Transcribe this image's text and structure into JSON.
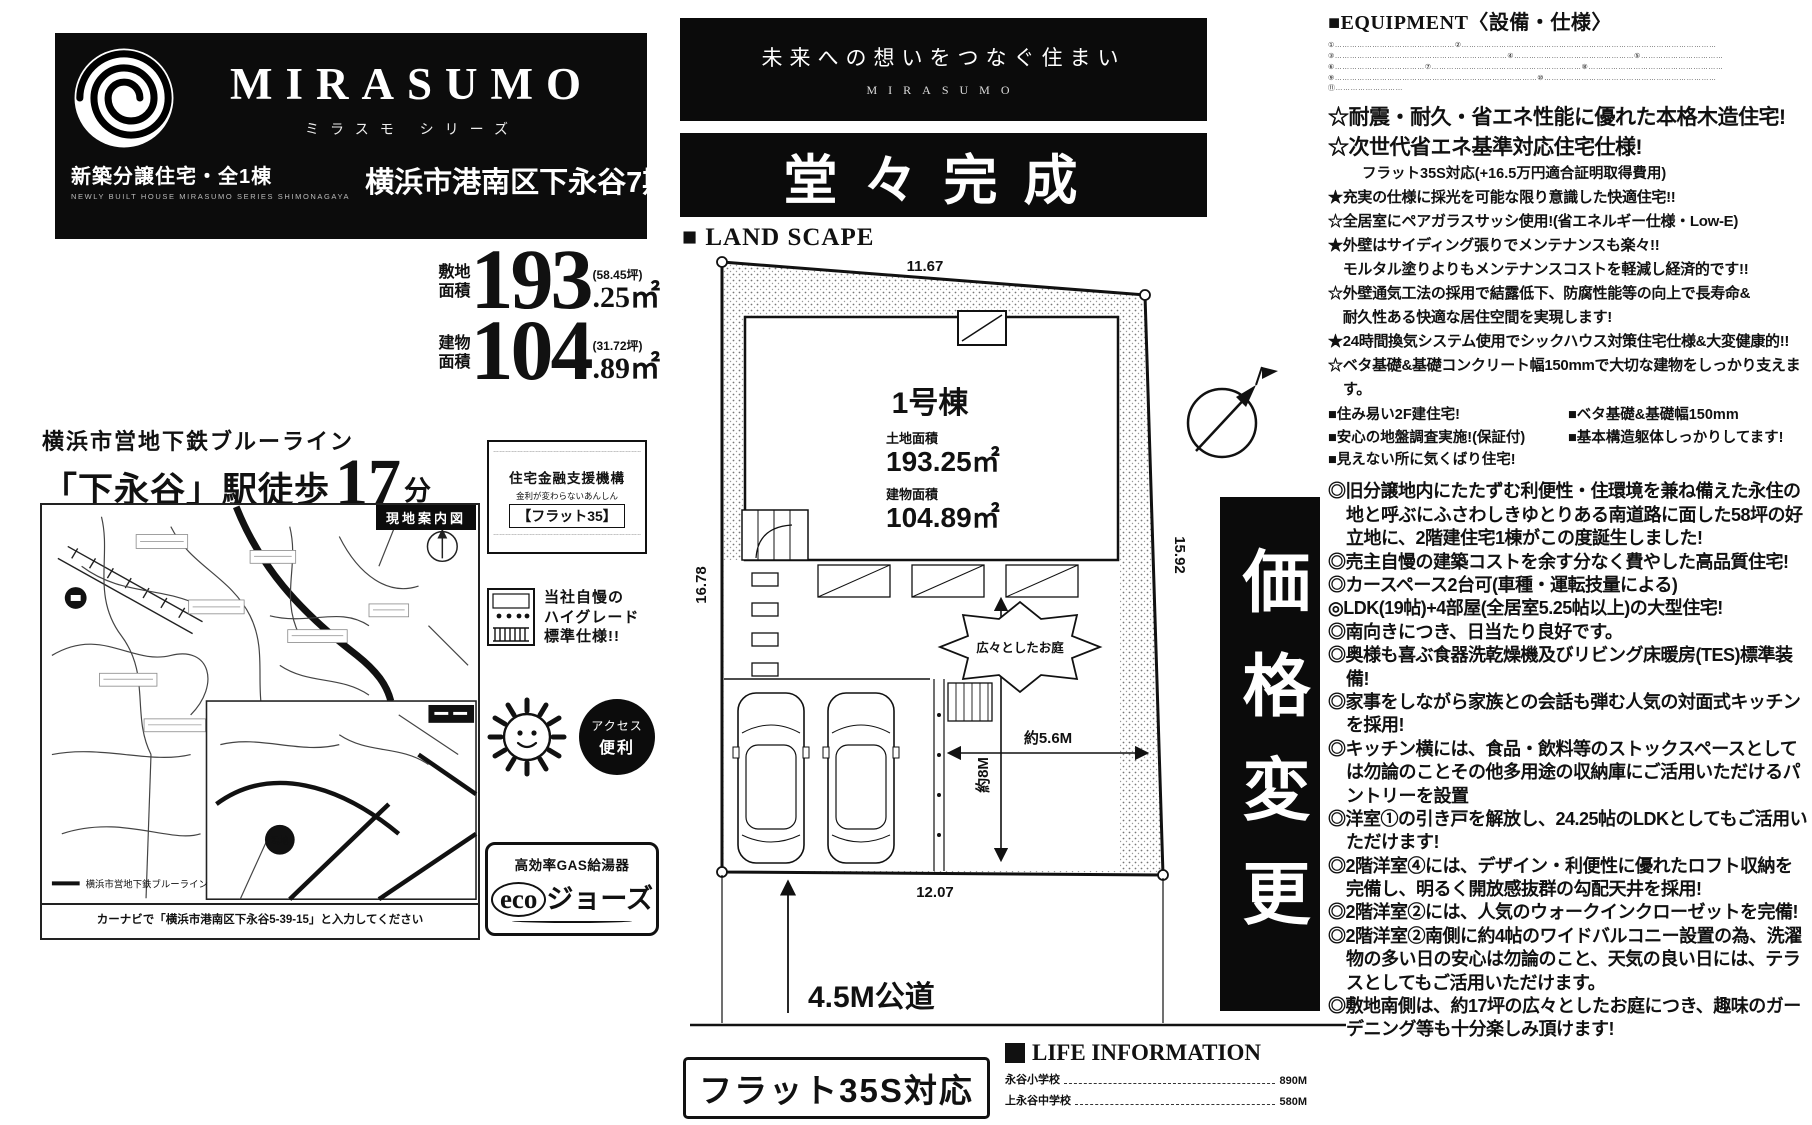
{
  "brand": {
    "name": "MIRASUMO",
    "series": "ミラスモ シリーズ",
    "type": "新築分譲住宅・全1棟",
    "type_sub": "NEWLY BUILT HOUSE MIRASUMO SERIES SHIMONAGAYA",
    "address": "横浜市港南区下永谷7期"
  },
  "stats": {
    "land": {
      "l1": "敷地",
      "l2": "面積",
      "num": "193",
      "tsubo": "(58.45坪)",
      "dec": ".25㎡"
    },
    "building": {
      "l1": "建物",
      "l2": "面積",
      "num": "104",
      "tsubo": "(31.72坪)",
      "dec": ".89㎡"
    }
  },
  "access": {
    "line": "横浜市営地下鉄ブルーライン",
    "station": "「下永谷」駅徒歩",
    "minutes": "17",
    "unit": "分"
  },
  "map": {
    "label": "現地案内図",
    "blue_line_note": "横浜市営地下鉄ブルーライン",
    "site_mark": "現地",
    "caption": "カーナビで「横浜市港南区下永谷5-39-15」と入力してください"
  },
  "badges": {
    "flat35": {
      "org": "住宅金融支援機構",
      "sub": "金利が変わらないあんしん",
      "name": "【フラット35】",
      "fine": "……………………………………………………………………………………………………………………………………"
    },
    "grade": {
      "l1": "当社自慢の",
      "l2": "ハイグレード",
      "l3": "標準仕様!!"
    },
    "access_circle": {
      "l1": "アクセス",
      "l2": "便利"
    },
    "eco": {
      "l1": "高効率GAS給湯器",
      "eco": "eco",
      "jaws": "ジョーズ"
    }
  },
  "hero": {
    "tagline": "未来への想いをつなぐ住まい",
    "brand": "MIRASUMO",
    "completion": "堂々完成",
    "landscape": "■ LAND SCAPE"
  },
  "plan": {
    "unit": "1号棟",
    "land_label": "土地面積",
    "land_area": "193.25㎡",
    "bld_label": "建物面積",
    "bld_area": "104.89㎡",
    "dim_top": "11.67",
    "dim_left": "16.78",
    "dim_right": "15.92",
    "dim_bottom": "12.07",
    "w_arrow": "約5.6M",
    "h_arrow": "約8M",
    "garden": "広々としたお庭",
    "road": "4.5M公道"
  },
  "price_change": "価格変更",
  "flat35s_box": "フラット35S対応",
  "life": {
    "heading": "LIFE INFORMATION",
    "rows": [
      {
        "name": "永谷小学校",
        "dist": "890M"
      },
      {
        "name": "上永谷中学校",
        "dist": "580M"
      }
    ]
  },
  "equipment": {
    "heading": "■EQUIPMENT〈設備・仕様〉",
    "fine_print": [
      "①…………………………………………②…………………………………………………………………………………………",
      "③……………………………………………………………④…………………………………………⑤……………………………",
      "⑥………………………………⑦……………………………………………………⑧………………………………………………",
      "⑨………………………………………………………………………⑩……………………………………………………………",
      "⑪………………………"
    ]
  },
  "features": {
    "h1": "☆耐震・耐久・省エネ性能に優れた本格木造住宅!",
    "h2": "☆次世代省エネ基準対応住宅仕様!",
    "h3": "フラット35S対応(+16.5万円適合証明取得費用)",
    "stars": [
      "★充実の仕様に採光を可能な限り意識した快適住宅!!",
      "☆全居室にペアガラスサッシ使用!(省エネルギー仕様・Low-E)",
      "★外壁はサイディング張りでメンテナンスも楽々!!",
      "　モルタル塗りよりもメンテナンスコストを軽減し経済的です!!",
      "☆外壁通気工法の採用で結露低下、防腐性能等の向上で長寿命&",
      "　耐久性ある快適な居住空間を実現します!",
      "★24時間換気システム使用でシックハウス対策住宅仕様&大変健康的!!",
      "☆ベタ基礎&基礎コンクリート幅150mmで大切な建物をしっかり支えます。"
    ],
    "checks": [
      "■住み易い2F建住宅!",
      "■ベタ基礎&基礎幅150mm",
      "■安心の地盤調査実施!(保証付)",
      "■基本構造躯体しっかりしてます!",
      "■見えない所に気くばり住宅!"
    ],
    "points": [
      "◎旧分譲地内にたたずむ利便性・住環境を兼ね備えた永住の地と呼ぶにふさわしきゆとりある南道路に面した58坪の好立地に、2階建住宅1棟がこの度誕生しました!",
      "◎売主自慢の建築コストを余す分なく費やした高品質住宅!",
      "◎カースペース2台可(車種・運転技量による)",
      "◎LDK(19帖)+4部屋(全居室5.25帖以上)の大型住宅!",
      "◎南向きにつき、日当たり良好です。",
      "◎奥様も喜ぶ食器洗乾燥機及びリビング床暖房(TES)標準装備!",
      "◎家事をしながら家族との会話も弾む人気の対面式キッチンを採用!",
      "◎キッチン横には、食品・飲料等のストックスペースとしては勿論のことその他多用途の収納庫にご活用いただけるパントリーを設置",
      "◎洋室①の引き戸を解放し、24.25帖のLDKとしてもご活用いただけます!",
      "◎2階洋室④には、デザイン・利便性に優れたロフト収納を完備し、明るく開放感抜群の勾配天井を採用!",
      "◎2階洋室②には、人気のウォークインクローゼットを完備!",
      "◎2階洋室②南側に約4帖のワイドバルコニー設置の為、洗濯物の多い日の安心は勿論のこと、天気の良い日には、テラスとしてもご活用いただけます。",
      "◎敷地南側は、約17坪の広々としたお庭につき、趣味のガーデニング等も十分楽しみ頂けます!"
    ]
  }
}
